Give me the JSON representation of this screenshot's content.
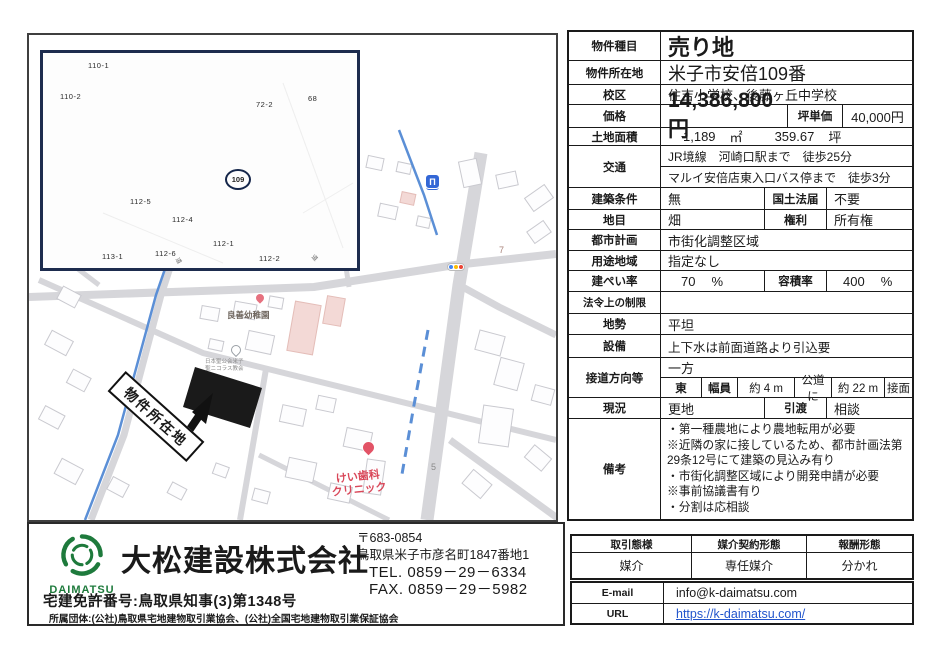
{
  "colors": {
    "accent_green": "#1e7a3c",
    "canal_blue": "#5b8fd6",
    "dental_red": "#d9485a",
    "link_blue": "#2255cc",
    "parcel_black": "#1a1a1a"
  },
  "map": {
    "inset": {
      "parcels": [
        "110-1",
        "110-2",
        "72-2",
        "68",
        "112-5",
        "112-4",
        "112-1",
        "113-1",
        "112-6",
        "112-2"
      ],
      "circled_parcel": "109",
      "road_label_1": "道",
      "road_label_2": "道"
    },
    "labels": {
      "property_location": "物件所在地",
      "kindergarten": "良善幼稚園",
      "church_line1": "日本聖公会米子",
      "church_line2": "聖ニコラス教会",
      "dental_line1": "けい歯科",
      "dental_line2": "クリニック",
      "route_7": "7",
      "route_5": "5"
    },
    "icons": {
      "bridge_glyph": "Π"
    }
  },
  "table": {
    "type": {
      "label": "物件種目",
      "value": "売り地"
    },
    "location": {
      "label": "物件所在地",
      "value": "米子市安倍109番"
    },
    "school": {
      "label": "校区",
      "value": "住吉小学校、後藤ヶ丘中学校"
    },
    "price": {
      "label": "価格",
      "value": "14,386,800円",
      "unit_label": "坪単価",
      "unit_value": "40,000円"
    },
    "area": {
      "label": "土地面積",
      "sqm": "1,189",
      "sqm_unit": "㎡",
      "tsubo": "359.67",
      "tsubo_unit": "坪"
    },
    "access": {
      "label": "交通",
      "line1": "JR境線　河崎口駅まで　徒歩25分",
      "line2": "マルイ安倍店東入口バス停まで　徒歩3分"
    },
    "building_condition": {
      "label": "建築条件",
      "value": "無",
      "sub_label": "国土法届",
      "sub_value": "不要"
    },
    "land_category": {
      "label": "地目",
      "value": "畑",
      "sub_label": "権利",
      "sub_value": "所有権"
    },
    "city_planning": {
      "label": "都市計画",
      "value": "市街化調整区域"
    },
    "zoning": {
      "label": "用途地域",
      "value": "指定なし"
    },
    "coverage": {
      "label": "建ぺい率",
      "value": "70",
      "unit": "%",
      "sub_label": "容積率",
      "sub_value": "400",
      "sub_unit": "%"
    },
    "legal": {
      "label": "法令上の制限",
      "value": ""
    },
    "terrain": {
      "label": "地勢",
      "value": "平坦"
    },
    "utilities": {
      "label": "設備",
      "value": "上下水は前面道路より引込要"
    },
    "road": {
      "label": "接道方向等",
      "value": "一方",
      "dir": "東",
      "width_label": "幅員",
      "width_value": "約 4 m",
      "road_kind": "公道に",
      "frontage": "約 22 m",
      "face_label": "接面"
    },
    "status": {
      "label": "現況",
      "value": "更地",
      "sub_label": "引渡",
      "sub_value": "相談"
    },
    "remarks": {
      "label": "備考",
      "lines": [
        "・第一種農地により農地転用が必要",
        "※近隣の家に接しているため、都市計画法第29条12号にて建築の見込み有り",
        "・市街化調整区域により開発申請が必要",
        "※事前協議書有り",
        "・分割は応相談"
      ]
    }
  },
  "deal": {
    "headers": [
      "取引態様",
      "媒介契約形態",
      "報酬形態"
    ],
    "values": [
      "媒介",
      "専任媒介",
      "分かれ"
    ]
  },
  "contact": {
    "email_label": "E-mail",
    "email": "info@k-daimatsu.com",
    "url_label": "URL",
    "url": "https://k-daimatsu.com/"
  },
  "agency": {
    "logo_text": "DAIMATSU",
    "logo_subtext": "CONSTRUCTION",
    "name": "大松建設株式会社",
    "postal": "〒683-0854",
    "address": "鳥取県米子市彦名町1847番地1",
    "tel": "TEL. 0859－29－6334",
    "fax": "FAX. 0859－29－5982",
    "license": "宅建免許番号:鳥取県知事(3)第1348号",
    "associations": "所属団体:(公社)鳥取県宅地建物取引業協会、(公社)全国宅地建物取引業保証協会"
  }
}
